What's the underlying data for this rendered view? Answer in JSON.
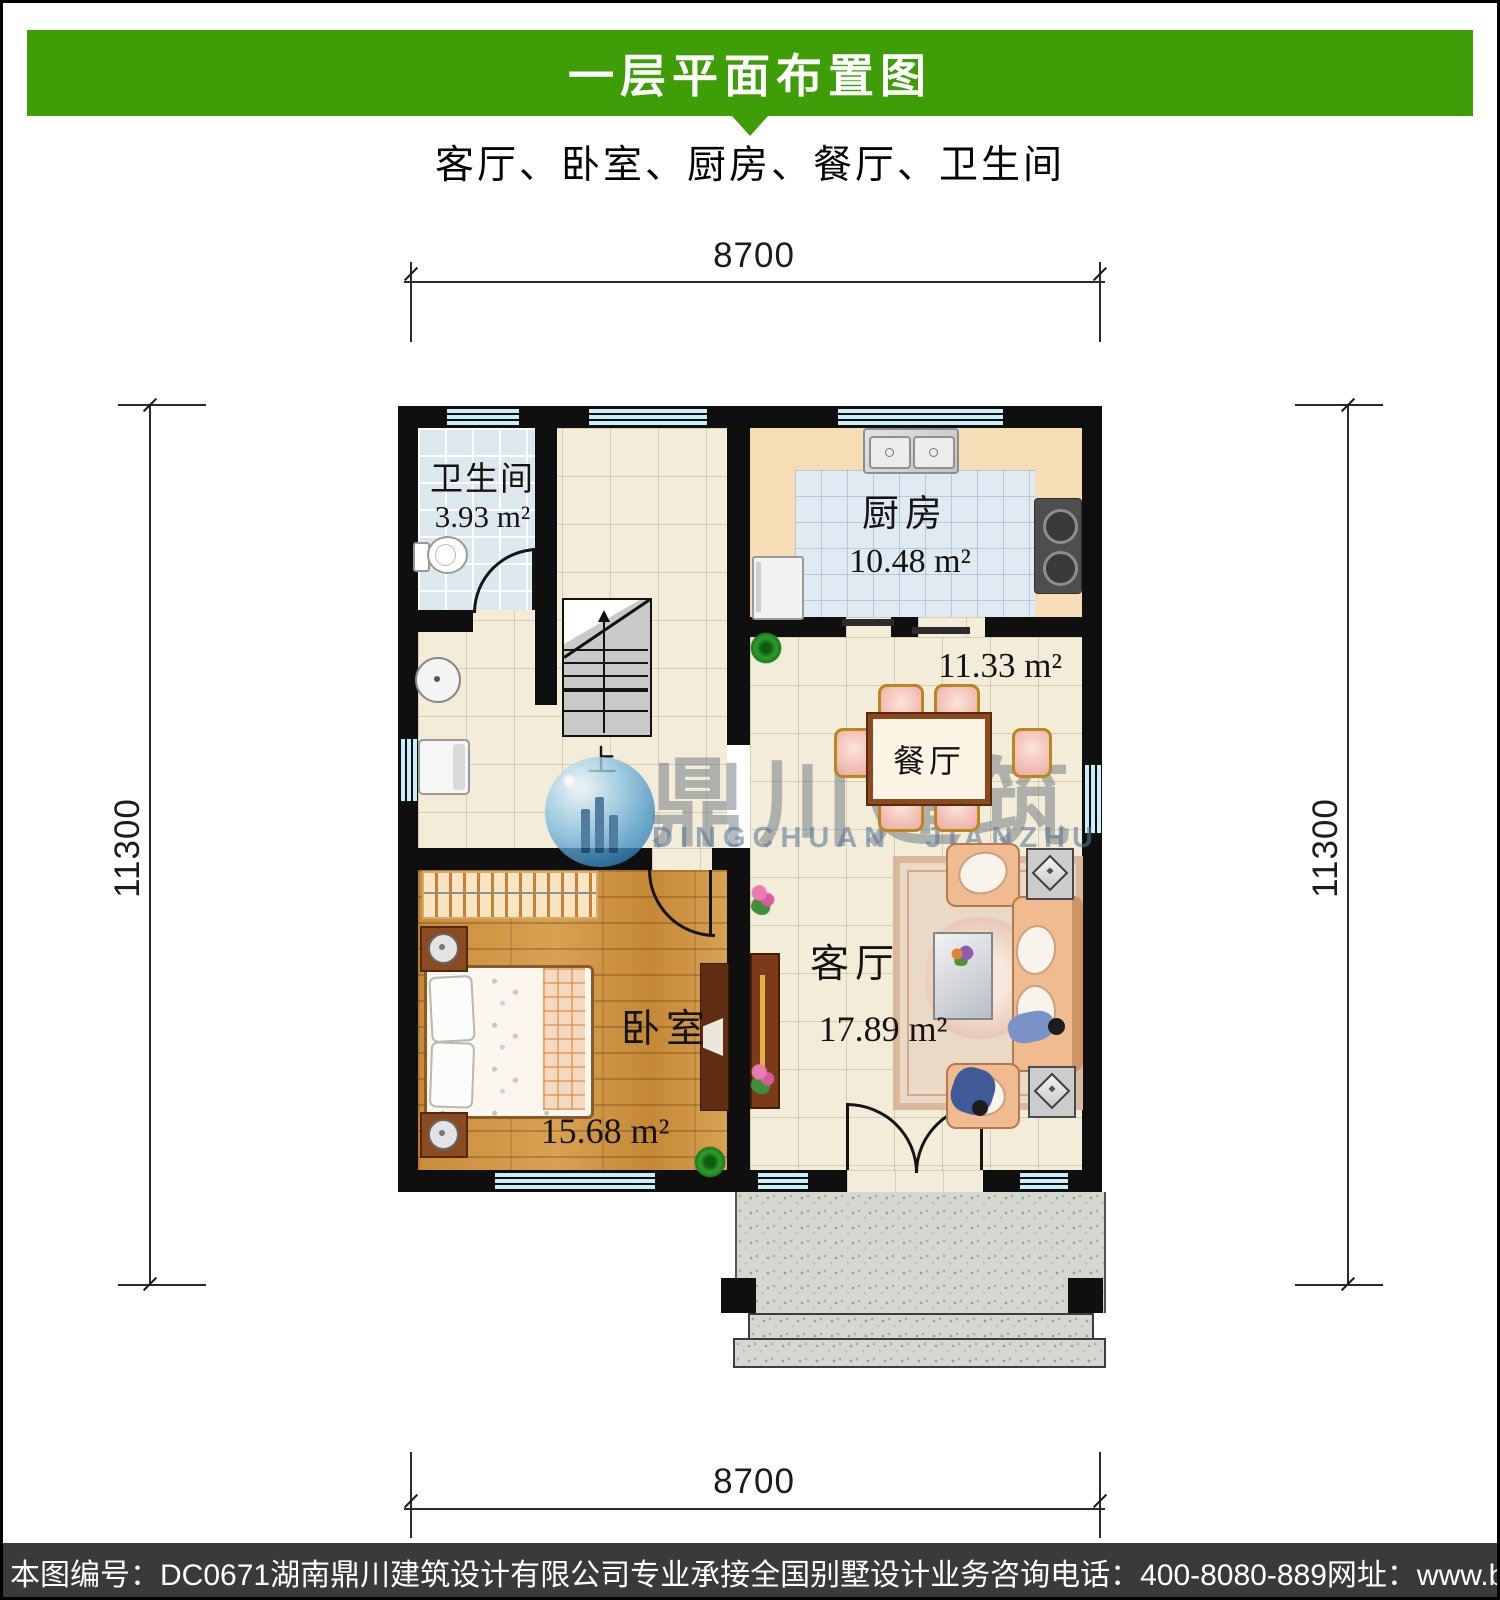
{
  "header": {
    "title": "一层平面布置图",
    "subtitle": "客厅、卧室、厨房、餐厅、卫生间"
  },
  "dimensions": {
    "top": "8700",
    "bottom": "8700",
    "left": "11300",
    "right": "11300"
  },
  "rooms": {
    "bathroom": {
      "label": "卫生间",
      "area": "3.93 m²"
    },
    "kitchen": {
      "label": "厨房",
      "area": "10.48 m²"
    },
    "dining": {
      "label": "餐厅",
      "area": "11.33 m²"
    },
    "living": {
      "label": "客厅",
      "area": "17.89 m²"
    },
    "bedroom": {
      "label": "卧室",
      "area": "15.68 m²"
    }
  },
  "stairs": {
    "up_label": "上"
  },
  "watermark": {
    "name_cn": "鼎川建筑",
    "name_en": "DINGCHUAN JIANZHU"
  },
  "footer": {
    "drawing_no": "本图编号：DC0671",
    "company": "湖南鼎川建筑设计有限公司专业承接全国别墅设计业务",
    "phone": "咨询电话：400-8080-889",
    "website": "网址：www.bstzcs.com"
  },
  "fixtures": [
    "toilet",
    "wash-basin",
    "washing-machine",
    "kitchen-sink",
    "stove",
    "fridge",
    "stairs",
    "dining-table",
    "chairs",
    "sofa-set",
    "coffee-table",
    "carpet",
    "tv-cabinet",
    "bed",
    "wardrobe",
    "nightstands",
    "plants",
    "porch-steps"
  ],
  "colors": {
    "header_green": "#3f9e07",
    "footer_bg": "#3a3a3a",
    "wall_black": "#0f0f0f",
    "window_cyan": "#c9eef7",
    "floor_beige": "#f2ecd8",
    "bath_tile": "#dde8ee",
    "kitchen_counter": "#f6ddb5",
    "kitchen_tile": "#dfeaf3",
    "wood_floor": "#cd9342",
    "granite": "#d5d8d1",
    "watermark_blue": "#3c8cc0"
  }
}
